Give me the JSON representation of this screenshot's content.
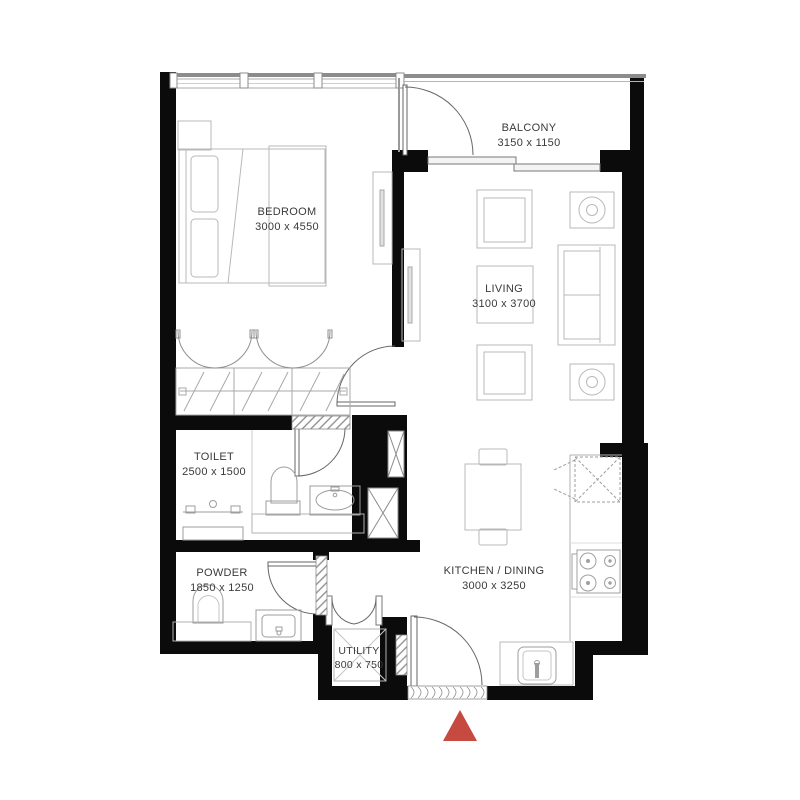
{
  "plan": {
    "type": "apartment-floor-plan",
    "rooms": [
      {
        "id": "bedroom",
        "name": "BEDROOM",
        "dimensions": "3000 x 4550"
      },
      {
        "id": "balcony",
        "name": "BALCONY",
        "dimensions": "3150 x 1150"
      },
      {
        "id": "living",
        "name": "LIVING",
        "dimensions": "3100 x 3700"
      },
      {
        "id": "toilet",
        "name": "TOILET",
        "dimensions": "2500 x 1500"
      },
      {
        "id": "powder",
        "name": "POWDER",
        "dimensions": "1850 x 1250"
      },
      {
        "id": "kitchen_dining",
        "name": "KITCHEN / DINING",
        "dimensions": "3000 x 3250"
      },
      {
        "id": "utility",
        "name": "UTILITY",
        "dimensions": "800 x 750"
      }
    ],
    "colors": {
      "wall": "#0b0b0b",
      "furniture_line": "#b8b8b8",
      "fixture_line": "#999999",
      "door_line": "#666666",
      "label_text": "#3a3a3a",
      "entrance_marker": "#c64a3f"
    },
    "markers": {
      "entrance_marker": "red triangle pointing up at main entrance"
    }
  }
}
